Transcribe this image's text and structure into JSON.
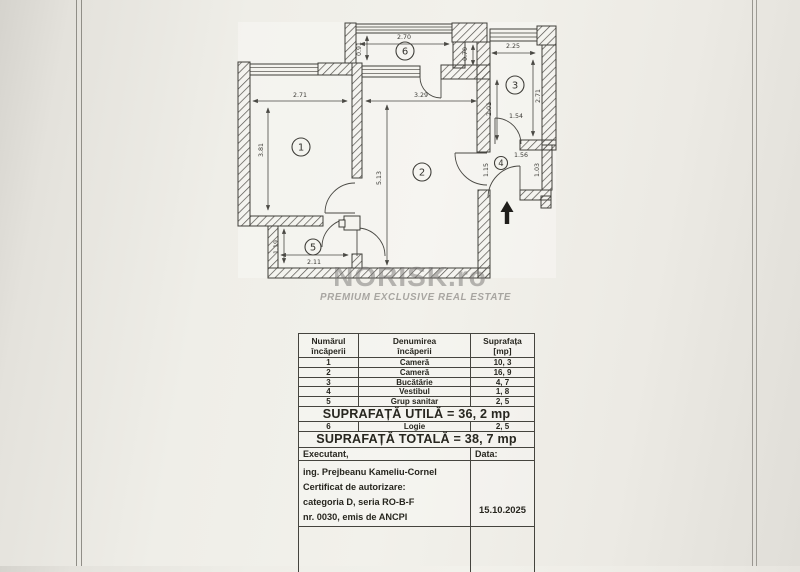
{
  "colors": {
    "paper": "#f1f0ea",
    "ink": "#3f3e39",
    "watermark_gray": "#787673"
  },
  "watermark": {
    "brand": "NORISK.ro",
    "tagline": "PREMIUM EXCLUSIVE REAL ESTATE"
  },
  "plan": {
    "rooms": [
      "1",
      "2",
      "3",
      "4",
      "5",
      "6"
    ],
    "dims": {
      "room1_w": "2.71",
      "room1_h": "3.81",
      "room2_w": "3.29",
      "room2_h": "5.13",
      "logia_w": "2.70",
      "logia_h": "0.91",
      "kitchen_w": "2.25",
      "kitchen_h": "2.71",
      "wall_offset": "0.70",
      "kitchen_side": "2.01",
      "door_kitchen": "1.54",
      "room4_w": "1.56",
      "room4_door": "1.15",
      "room4_h": "1.03",
      "room5_h": "1.19",
      "room5_w": "2.11"
    }
  },
  "table": {
    "header": {
      "c1a": "Numărul",
      "c1b": "încăperii",
      "c2a": "Denumirea",
      "c2b": "încăperii",
      "c3a": "Suprafața",
      "c3b": "[mp]"
    },
    "rows": [
      {
        "num": "1",
        "name": "Cameră",
        "area": "10, 3"
      },
      {
        "num": "2",
        "name": "Cameră",
        "area": "16, 9"
      },
      {
        "num": "3",
        "name": "Bucătărie",
        "area": "4, 7"
      },
      {
        "num": "4",
        "name": "Vestibul",
        "area": "1, 8"
      },
      {
        "num": "5",
        "name": "Grup sanitar",
        "area": "2, 5"
      }
    ],
    "utila": "SUPRAFAȚĂ UTILĂ = 36, 2 mp",
    "logie_row": {
      "num": "6",
      "name": "Logie",
      "area": "2, 5"
    },
    "totala": "SUPRAFAȚĂ TOTALĂ = 38, 7 mp",
    "executant_label": "Executant,",
    "data_label": "Data:",
    "executant_lines": [
      "ing. Prejbeanu Kameliu-Cornel",
      "Certificat de autorizare:",
      "categoria D, seria RO-B-F",
      "nr. 0030, emis de ANCPI"
    ],
    "date": "15.10.2025"
  }
}
